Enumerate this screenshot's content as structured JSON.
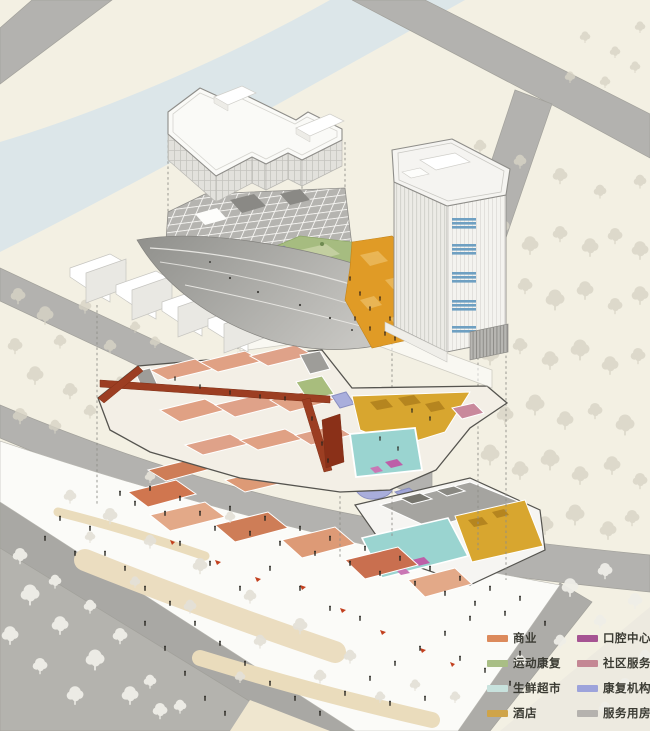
{
  "figure": {
    "kind": "exploded axonometric architecture diagram",
    "levels_shown": 4
  },
  "legend": {
    "columns": [
      {
        "items": [
          {
            "label": "商业",
            "color": "#DC8A5C"
          },
          {
            "label": "运动康复",
            "color": "#A9BE85"
          },
          {
            "label": "生鲜超市",
            "color": "#C8E2DD"
          },
          {
            "label": "酒店",
            "color": "#CFA449"
          }
        ]
      },
      {
        "items": [
          {
            "label": "口腔中心",
            "color": "#A65493"
          },
          {
            "label": "社区服务",
            "color": "#C48794"
          },
          {
            "label": "康复机构",
            "color": "#9DA3DB"
          },
          {
            "label": "服务用房",
            "color": "#B5B2AE"
          }
        ]
      }
    ]
  },
  "colors": {
    "background": "#F3F0E3",
    "water": "#DCE6E9",
    "road": "#B3B2AF",
    "road_dark": "#A9A8A4",
    "plaza": "#FBFBF8",
    "sand_path": "#EADCBC",
    "plaza_orange": "#E09B26",
    "corridor_red": "#9C3E22",
    "pool_teal": "#9AD4D0",
    "yellow_floor": "#D8A62F",
    "green_roof": "#A6BC80",
    "lavender": "#A9AEDC",
    "magenta": "#BD5FA8",
    "terracotta": "#CE7D57",
    "salmon": "#E0A184",
    "tower_blue": "#6FA0C2"
  }
}
